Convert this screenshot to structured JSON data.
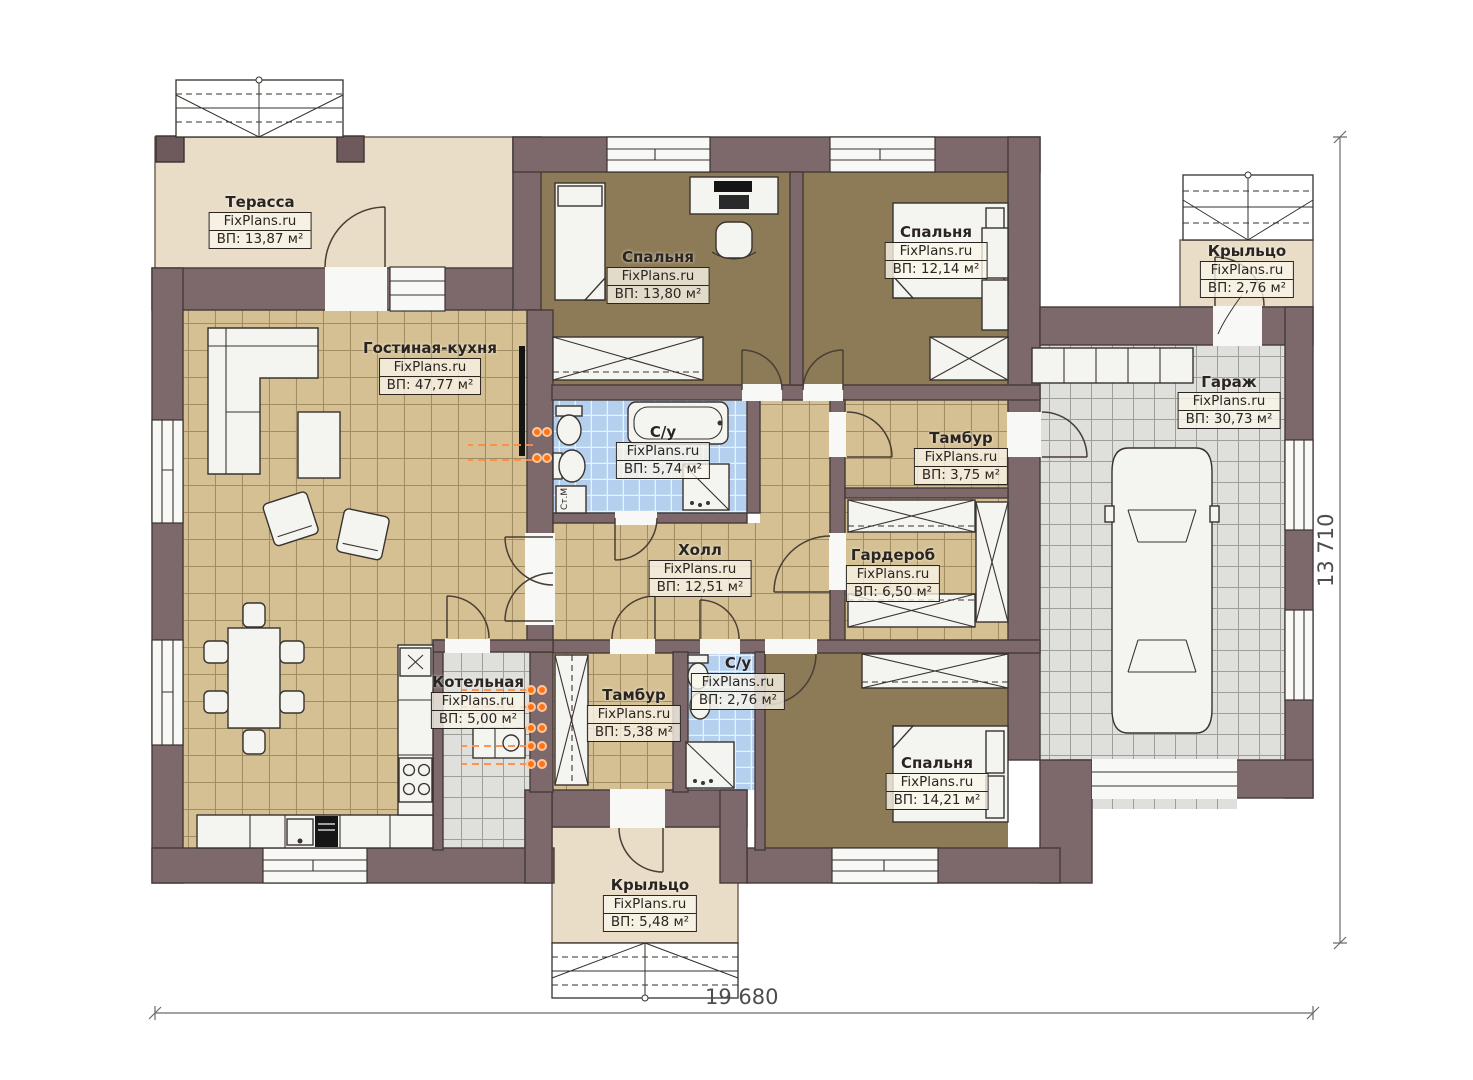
{
  "plan": {
    "brand": "FixPlans.ru",
    "rooms": [
      {
        "id": "terrace",
        "name": "Терасса",
        "area": "ВП: 13,87 м²"
      },
      {
        "id": "living",
        "name": "Гостиная-кухня",
        "area": "ВП: 47,77 м²"
      },
      {
        "id": "bedroom1",
        "name": "Спальня",
        "area": "ВП: 13,80 м²"
      },
      {
        "id": "bedroom2",
        "name": "Спальня",
        "area": "ВП: 12,14 м²"
      },
      {
        "id": "porch_top",
        "name": "Крыльцо",
        "area": "ВП: 2,76 м²"
      },
      {
        "id": "garage",
        "name": "Гараж",
        "area": "ВП: 30,73 м²"
      },
      {
        "id": "bath1",
        "name": "С/у",
        "area": "ВП: 5,74 м²"
      },
      {
        "id": "tambur1",
        "name": "Тамбур",
        "area": "ВП: 3,75 м²"
      },
      {
        "id": "hall",
        "name": "Холл",
        "area": "ВП: 12,51 м²"
      },
      {
        "id": "wardrobe",
        "name": "Гардероб",
        "area": "ВП: 6,50 м²"
      },
      {
        "id": "boiler",
        "name": "Котельная",
        "area": "ВП: 5,00 м²"
      },
      {
        "id": "tambur2",
        "name": "Тамбур",
        "area": "ВП: 5,38 м²"
      },
      {
        "id": "bath2",
        "name": "С/у",
        "area": "ВП: 2,76 м²"
      },
      {
        "id": "bedroom3",
        "name": "Спальня",
        "area": "ВП: 14,21 м²"
      },
      {
        "id": "porch_bottom",
        "name": "Крыльцо",
        "area": "ВП: 5,48 м²"
      }
    ],
    "dimensions": {
      "width": "19 680",
      "height": "13 710"
    },
    "appliances": {
      "washing_machine": "Ст.М"
    },
    "colors": {
      "wall": "#7d696c",
      "floor_wood": "#d4c093",
      "floor_bedroom": "#8d7a57",
      "tile_blue": "#b4d0ee",
      "tile_gray": "#dfdfdc",
      "terrace": "#e9ddc7",
      "radiator": "#ff7316"
    }
  }
}
